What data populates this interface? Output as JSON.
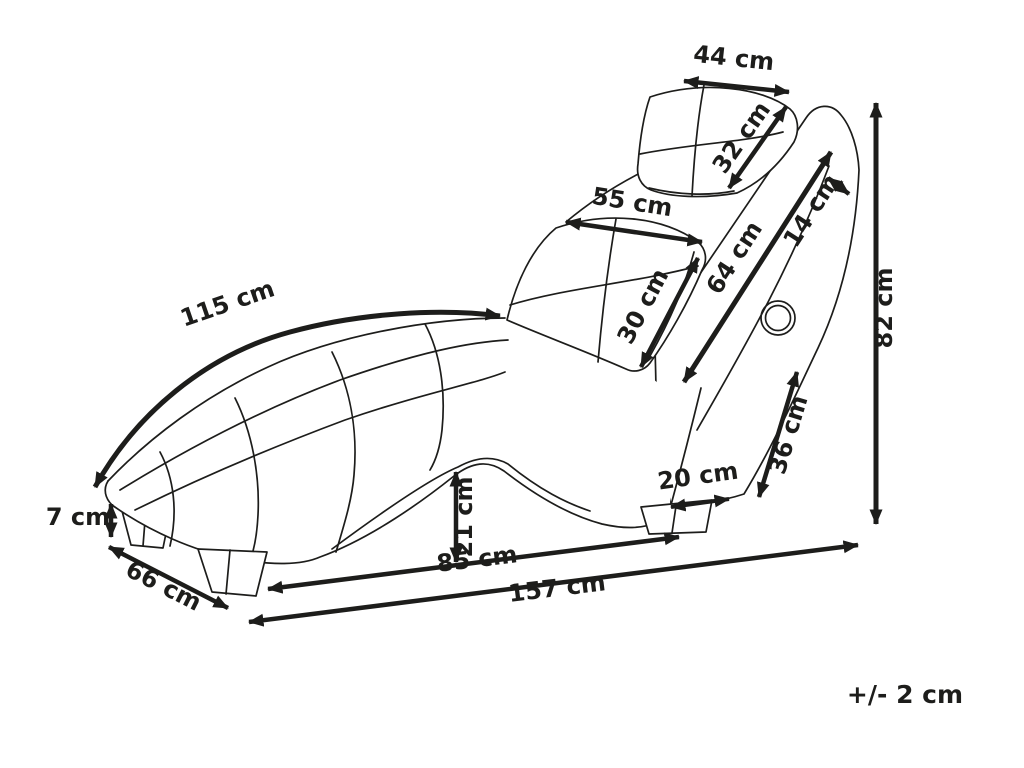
{
  "palette": {
    "background": "#ffffff",
    "line": "#1d1d1b",
    "text": "#1d1d1b"
  },
  "tolerance_note": "+/- 2 cm",
  "dimensions": {
    "headrest_width": {
      "label": "44 cm",
      "value": 44,
      "unit": "cm"
    },
    "headrest_depth": {
      "label": "32 cm",
      "value": 32,
      "unit": "cm"
    },
    "lumbar_width": {
      "label": "55 cm",
      "value": 55,
      "unit": "cm"
    },
    "lumbar_height": {
      "label": "30 cm",
      "value": 30,
      "unit": "cm"
    },
    "backrest_length": {
      "label": "64 cm",
      "value": 64,
      "unit": "cm"
    },
    "backrest_thickness": {
      "label": "14 cm",
      "value": 14,
      "unit": "cm"
    },
    "total_height": {
      "label": "82 cm",
      "value": 82,
      "unit": "cm"
    },
    "seat_curve_length": {
      "label": "115 cm",
      "value": 115,
      "unit": "cm"
    },
    "plinth_height": {
      "label": "7 cm",
      "value": 7,
      "unit": "cm"
    },
    "base_depth": {
      "label": "66 cm",
      "value": 66,
      "unit": "cm"
    },
    "arch_clearance": {
      "label": "21 cm",
      "value": 21,
      "unit": "cm"
    },
    "base_span": {
      "label": "85 cm",
      "value": 85,
      "unit": "cm"
    },
    "total_length": {
      "label": "157 cm",
      "value": 157,
      "unit": "cm"
    },
    "leg_spacing": {
      "label": "20 cm",
      "value": 20,
      "unit": "cm"
    },
    "rear_support": {
      "label": "36 cm",
      "value": 36,
      "unit": "cm"
    }
  }
}
